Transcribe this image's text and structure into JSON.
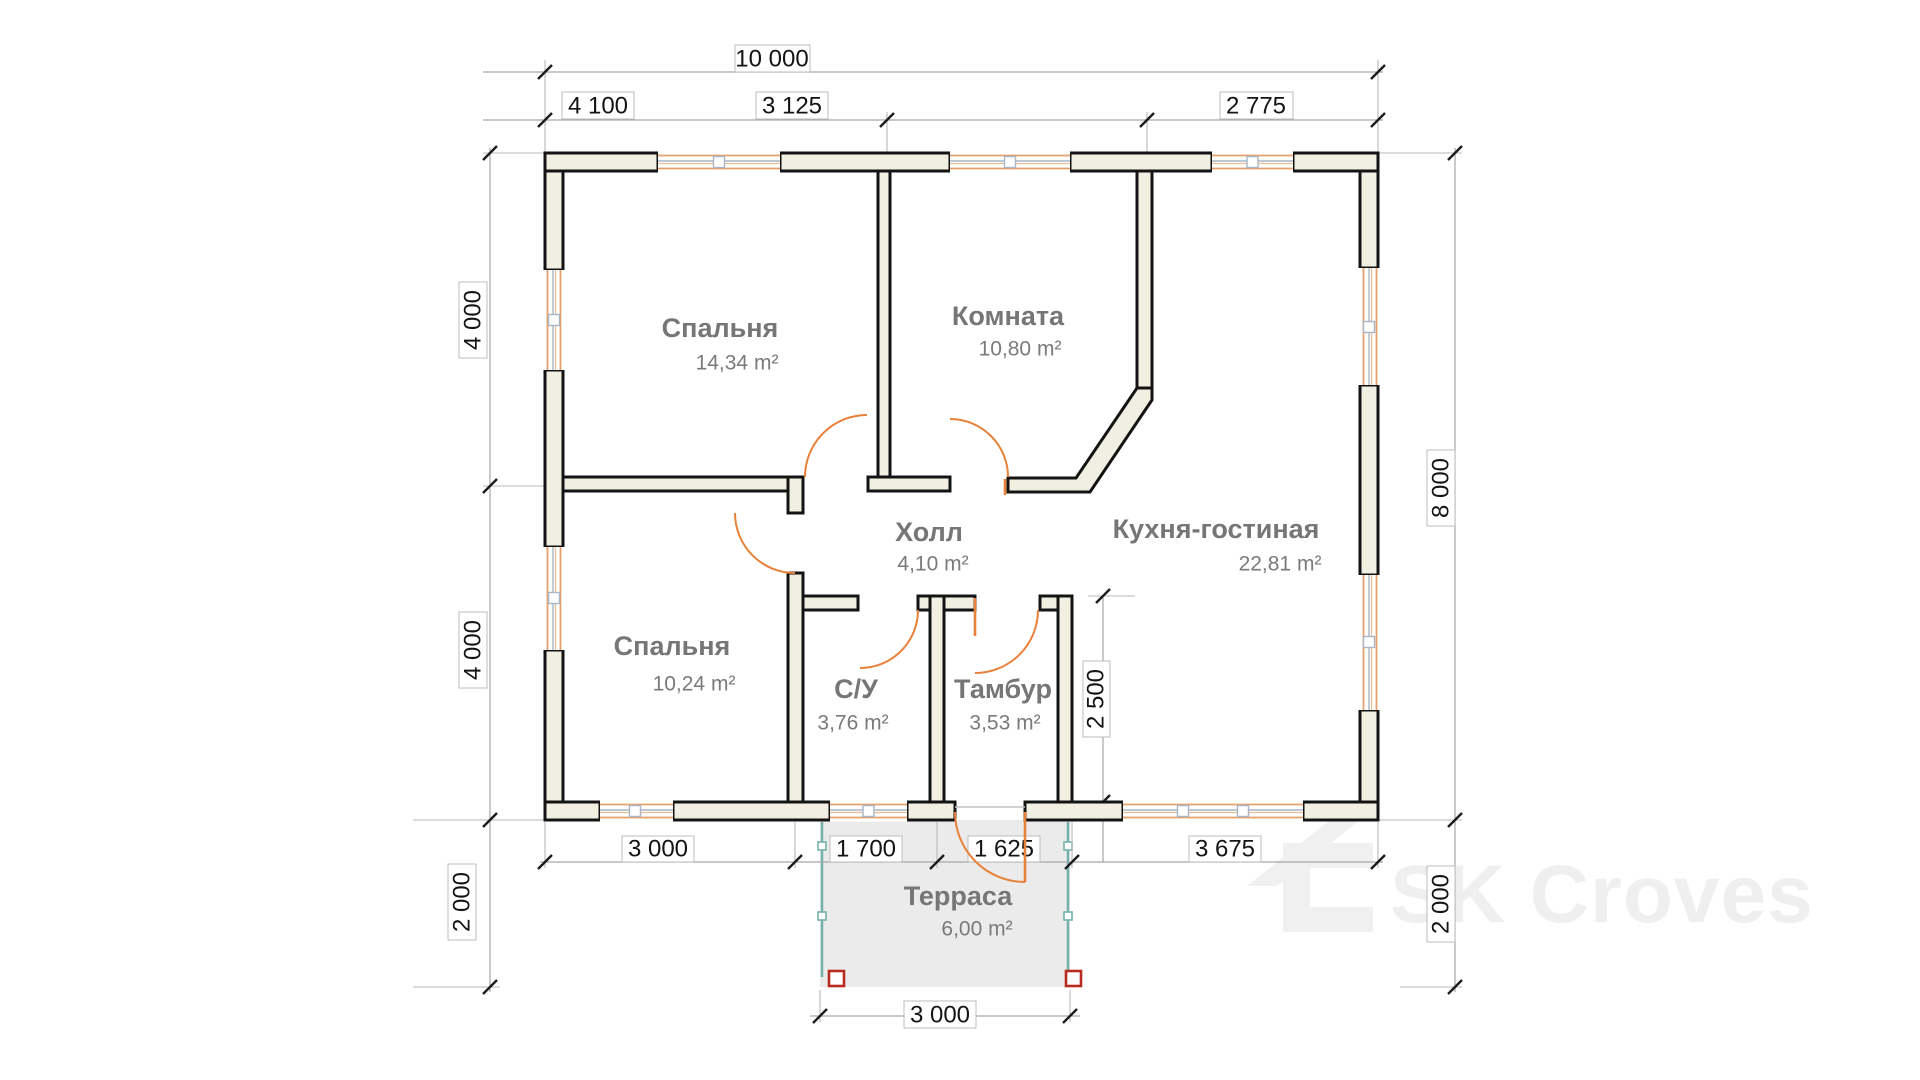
{
  "watermark": {
    "brand": "SK Croves"
  },
  "rooms": {
    "bedroom1": {
      "name": "Спальня",
      "area": "14,34 m²"
    },
    "room": {
      "name": "Комната",
      "area": "10,80 m²"
    },
    "hall": {
      "name": "Холл",
      "area": "4,10 m²"
    },
    "kitchen_living": {
      "name": "Кухня-гостиная",
      "area": "22,81 m²"
    },
    "bedroom2": {
      "name": "Спальня",
      "area": "10,24 m²"
    },
    "bathroom": {
      "name": "С/У",
      "area": "3,76 m²"
    },
    "vestibule": {
      "name": "Тамбур",
      "area": "3,53 m²"
    },
    "terrace": {
      "name": "Терраса",
      "area": "6,00 m²"
    }
  },
  "dimensions": {
    "top_total": "10 000",
    "top_segments": [
      "4 100",
      "3 125",
      "2 775"
    ],
    "left": [
      "4 000",
      "4 000",
      "2 000"
    ],
    "right": [
      "8 000",
      "2 000"
    ],
    "bottom_segments": [
      "3 000",
      "1 700",
      "1 625",
      "3 675"
    ],
    "terrace_width": "3 000",
    "vestibule_depth": "2 500"
  },
  "colors": {
    "wall_fill": "#f0efe2",
    "wall_stroke": "#141414",
    "window": "#e8a06a",
    "door": "#e8813a",
    "terrace_fill": "#ebebeb",
    "terrace_post": "#74b1aa",
    "terrace_anchor": "#b92b1e",
    "dim_line": "#a6a6a6",
    "room_label": "#767676",
    "watermark": "#efefef"
  }
}
